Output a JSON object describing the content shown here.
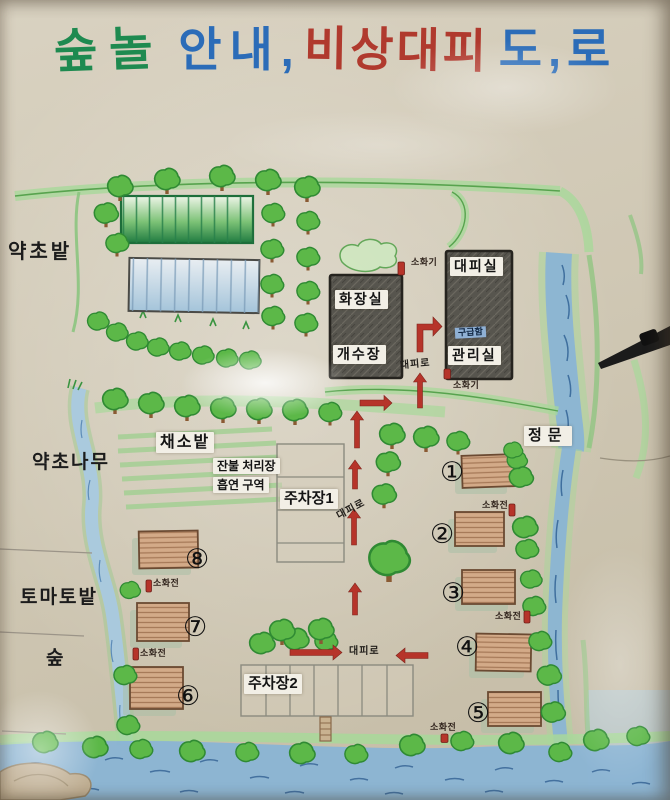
{
  "title": {
    "text_forest": "숲놀",
    "text_guide": "안내,",
    "text_emergency": "비상대피",
    "text_road": "도,로"
  },
  "area_labels": {
    "herb_field": "약초밭",
    "herb_trees": "약초나무",
    "tomato_field": "토마토밭",
    "forest": "숲",
    "vegetable_field": "채소밭",
    "main_gate": "정문"
  },
  "facility_labels": {
    "shelter_room": "대피실",
    "restroom": "화장실",
    "dish_washing": "개수장",
    "management_office": "관리실",
    "first_aid_kit": "구급함",
    "ember_disposal": "잔불 처리장",
    "smoking_zone": "흡연 구역",
    "parking_lot_1": "주차장1",
    "parking_lot_2": "주차장2"
  },
  "safety_labels": {
    "fire_extinguisher": "소화기",
    "fire_hydrant": "소화전",
    "evacuation_route": "대피로"
  },
  "cabin_numbers": {
    "c1": "①",
    "c2": "②",
    "c3": "③",
    "c4": "④",
    "c5": "⑤",
    "c6": "⑥",
    "c7": "⑦",
    "c8": "⑧"
  },
  "colors": {
    "board": "#cfc7b4",
    "title_green": "#1e8a50",
    "title_blue": "#2b6cb8",
    "title_red": "#b03a2e",
    "tree_green": "#5cb848",
    "water_blue": "#8ab4d4",
    "building_dark": "#57554e",
    "building_tan": "#d3aa88",
    "marker_red": "#b6342a"
  }
}
